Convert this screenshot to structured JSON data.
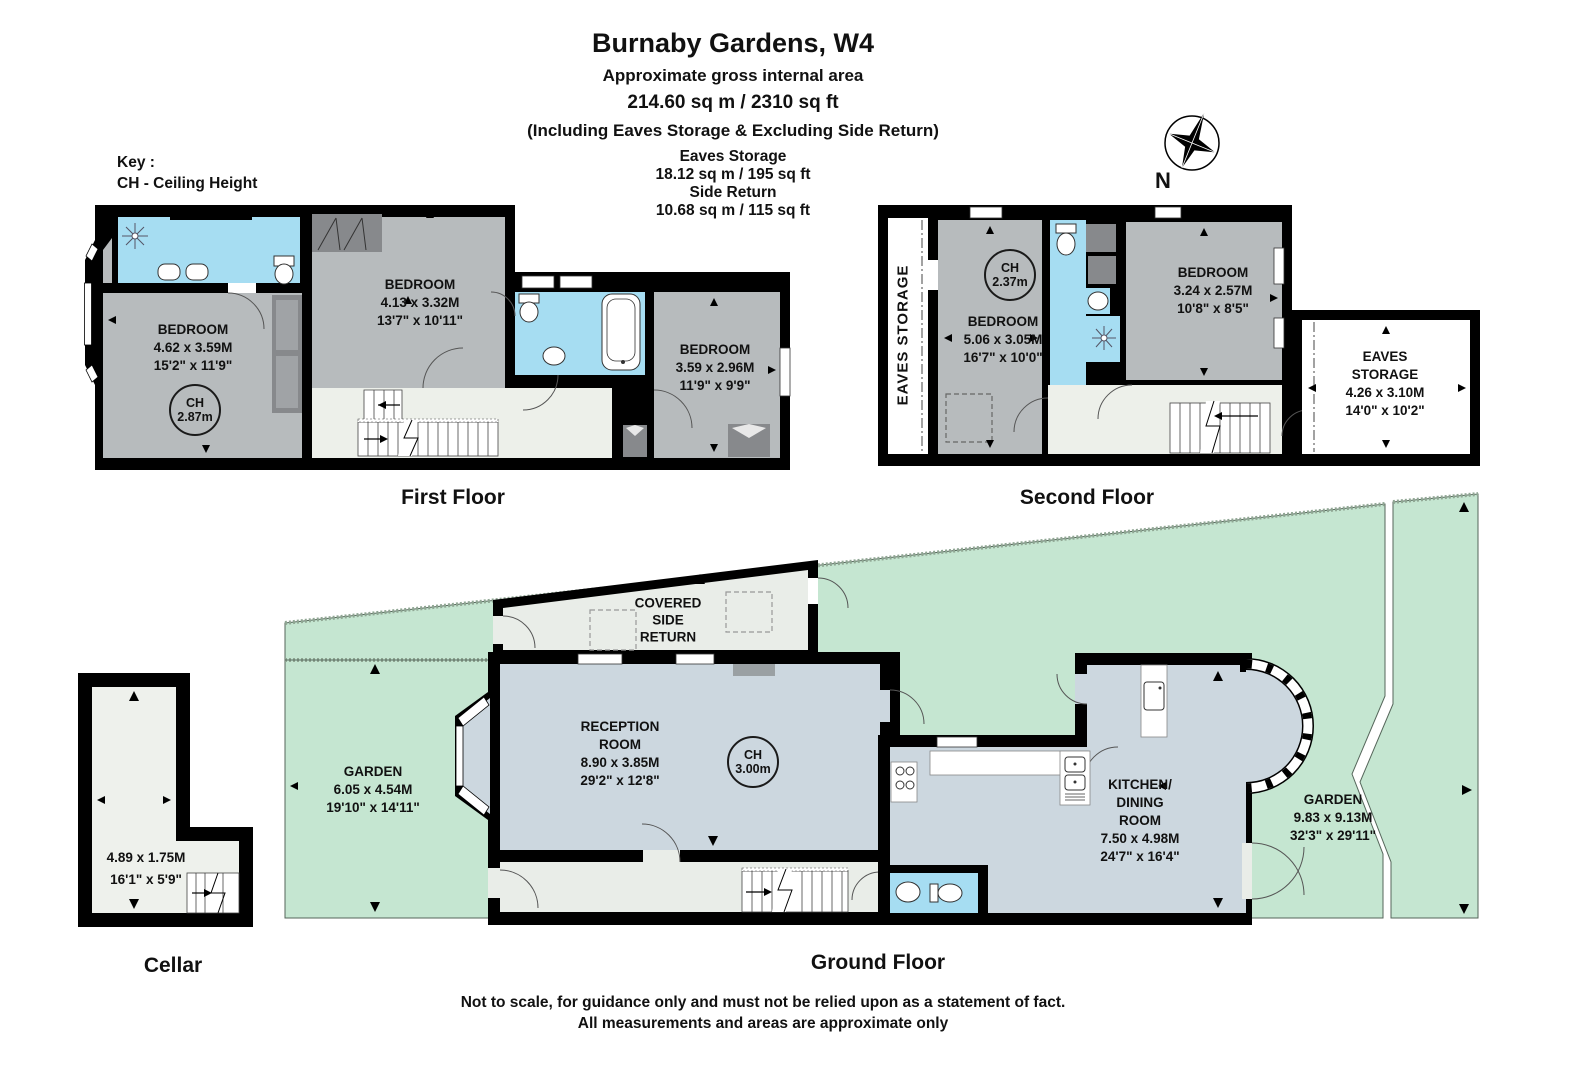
{
  "header": {
    "title": "Burnaby Gardens, W4",
    "gross_label": "Approximate gross internal area",
    "gross_value": "214.60 sq m /  2310 sq ft",
    "including": "(Including Eaves Storage & Excluding Side Return)",
    "eaves_label": "Eaves Storage",
    "eaves_value": "18.12 sq m /  195 sq ft",
    "side_label": "Side Return",
    "side_value": "10.68 sq m /  115 sq ft"
  },
  "key": {
    "line1": "Key :",
    "line2": "CH - Ceiling Height"
  },
  "compass": {
    "label": "N"
  },
  "floors": {
    "first": {
      "label": "First Floor",
      "bedroom1": {
        "name": "BEDROOM",
        "metric": "4.62 x 3.59M",
        "imperial": "15'2\" x 11'9\""
      },
      "ch": {
        "label": "CH",
        "value": "2.87m"
      },
      "bedroom2": {
        "name": "BEDROOM",
        "metric": "4.13 x 3.32M",
        "imperial": "13'7\" x 10'11\""
      },
      "bedroom3": {
        "name": "BEDROOM",
        "metric": "3.59 x 2.96M",
        "imperial": "11'9\" x 9'9\""
      }
    },
    "second": {
      "label": "Second Floor",
      "eaves_side": "EAVES STORAGE",
      "bedroom4": {
        "name": "BEDROOM",
        "metric": "5.06 x 3.05M",
        "imperial": "16'7\" x 10'0\""
      },
      "ch": {
        "label": "CH",
        "value": "2.37m"
      },
      "bedroom5": {
        "name": "BEDROOM",
        "metric": "3.24 x 2.57M",
        "imperial": "10'8\" x 8'5\""
      },
      "eaves_room": {
        "line1": "EAVES",
        "line2": "STORAGE",
        "metric": "4.26 x 3.10M",
        "imperial": "14'0\" x 10'2\""
      }
    },
    "ground": {
      "label": "Ground Floor",
      "covered": {
        "line1": "COVERED",
        "line2": "SIDE",
        "line3": "RETURN"
      },
      "garden_left": {
        "name": "GARDEN",
        "metric": "6.05 x 4.54M",
        "imperial": "19'10\" x 14'11\""
      },
      "reception": {
        "line1": "RECEPTION",
        "line2": "ROOM",
        "metric": "8.90 x 3.85M",
        "imperial": "29'2\" x 12'8\""
      },
      "ch": {
        "label": "CH",
        "value": "3.00m"
      },
      "kitchen": {
        "line1": "KITCHEN/",
        "line2": "DINING",
        "line3": "ROOM",
        "metric": "7.50 x 4.98M",
        "imperial": "24'7\" x 16'4\""
      },
      "garden_right": {
        "name": "GARDEN",
        "metric": "9.83 x 9.13M",
        "imperial": "32'3\" x 29'11\""
      }
    },
    "cellar": {
      "label": "Cellar",
      "room": {
        "metric": "4.89 x 1.75M",
        "imperial": "16'1\" x 5'9\""
      }
    }
  },
  "footer": {
    "line1": "Not to scale, for guidance only and must not be relied upon as a statement of fact.",
    "line2": "All measurements and areas are approximate only"
  },
  "colors": {
    "wall": "#000000",
    "bedroom_fill": "#b7bbbd",
    "bathroom_fill": "#a6ddf2",
    "living_fill": "#ccd7df",
    "hall_fill": "#e9ede8",
    "garden_fill": "#c5e6d1",
    "wardrobe_fill": "#87898c",
    "stairs_fill": "#ffffff"
  }
}
